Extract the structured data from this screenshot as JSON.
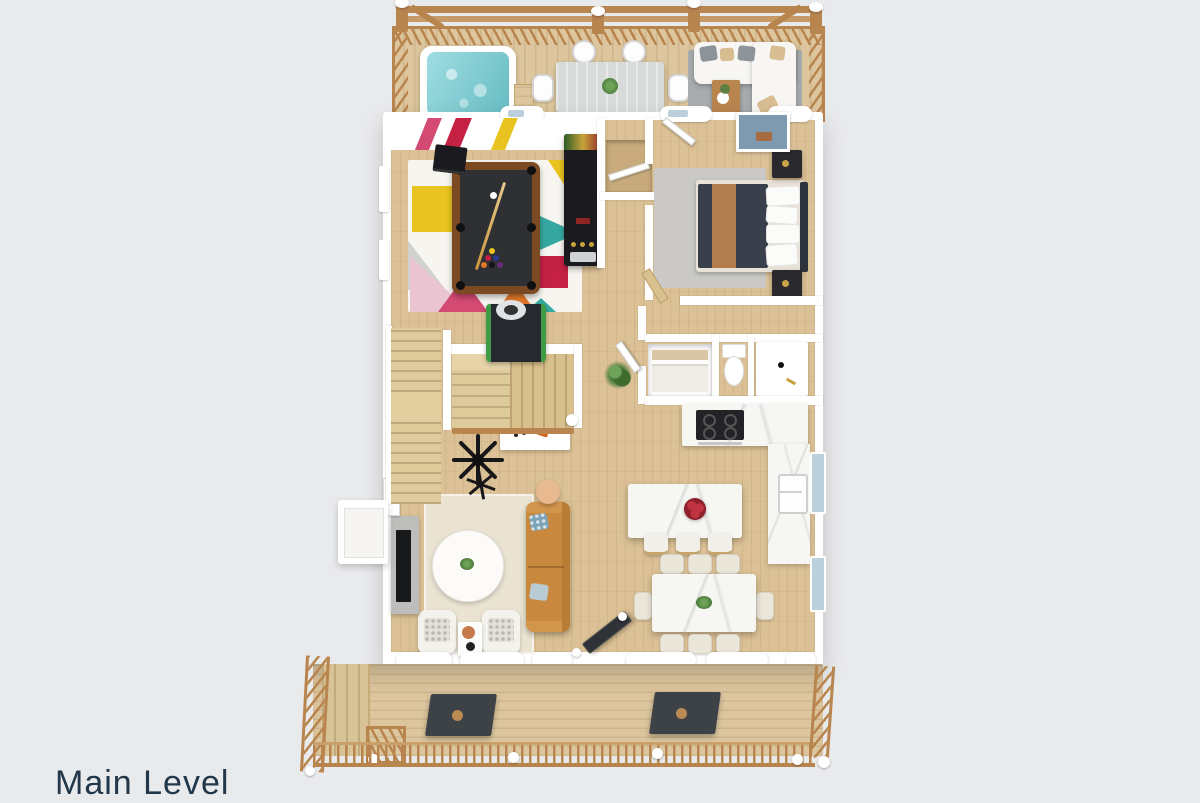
{
  "page": {
    "caption": "Main Level"
  },
  "palette": {
    "background": "#e9eaec",
    "caption_text": "#22384a",
    "deck_wood": "#ddc69e",
    "railing_wood": "#b9854f",
    "house_floor": "#dcc196",
    "wall_white": "#ffffff",
    "hot_tub_water": "#7ed2d8",
    "outdoor_table_gray": "#d7dbda",
    "outdoor_rug_gray": "#a8acad",
    "sofa_white": "#f7f6f2",
    "pillow_tan": "#d9bd92",
    "pillow_gray": "#8d9499",
    "game_rug_white": "#f7f5f0",
    "accent_yellow": "#e9c31f",
    "accent_red": "#c42145",
    "accent_magenta": "#d34a72",
    "accent_orange": "#e2782a",
    "accent_teal": "#35a9a1",
    "accent_pink": "#eac4d0",
    "pool_table_wood": "#7b4a22",
    "pool_table_felt": "#2f3034",
    "cue_wood": "#c9963f",
    "cabinet_black": "#1b1b1f",
    "bed_dark": "#3a404b",
    "blanket_tan": "#b17c4e",
    "bedroom_rug_gray": "#cac9c5",
    "marble_white": "#f6f6f3",
    "cooktop_black": "#232327",
    "chair_cream": "#eae6da",
    "fruit_red": "#901f2c",
    "living_rug_cream": "#eae3d2",
    "sofa_camel": "#c8893f",
    "pillow_blue": "#7ca3b8",
    "side_table_peach": "#e9b98f",
    "console_gray": "#bdbdbb",
    "door_dark": "#2f3236",
    "deck_table_dark": "#3d4246",
    "plant_green": "#4d7b3e",
    "window_blue": "#bccfdc"
  }
}
